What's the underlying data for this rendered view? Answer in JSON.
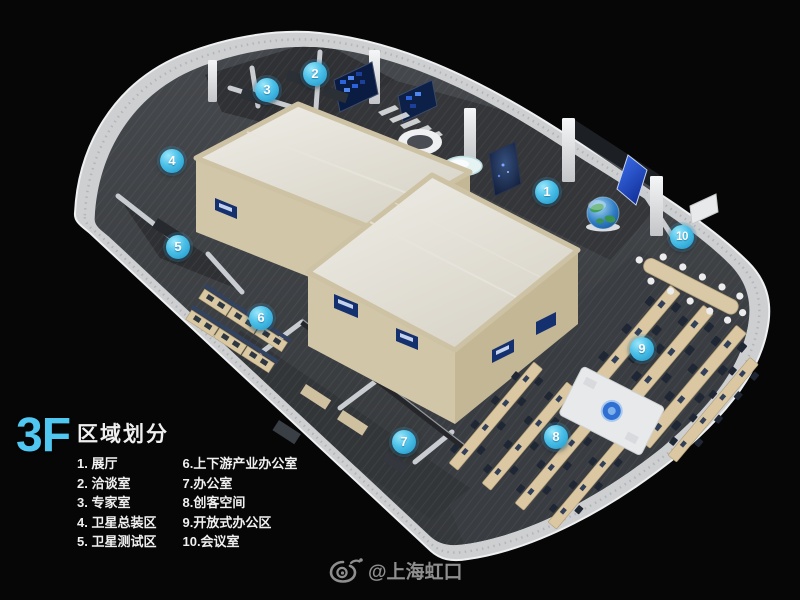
{
  "title": {
    "floor": "3F",
    "heading": "区域划分"
  },
  "legend": {
    "column1": [
      "1. 展厅",
      "2. 洽谈室",
      "3. 专家室",
      "4. 卫星总装区",
      "5. 卫星测试区"
    ],
    "column2": [
      "6.上下游产业办公室",
      "7.办公室",
      "8.创客空间",
      "9.开放式办公区",
      "10.会议室"
    ]
  },
  "area_markers": [
    {
      "label": "1",
      "x": 547,
      "y": 192
    },
    {
      "label": "2",
      "x": 315,
      "y": 74
    },
    {
      "label": "3",
      "x": 267,
      "y": 90
    },
    {
      "label": "4",
      "x": 172,
      "y": 161
    },
    {
      "label": "5",
      "x": 178,
      "y": 247
    },
    {
      "label": "6",
      "x": 261,
      "y": 318
    },
    {
      "label": "7",
      "x": 404,
      "y": 442
    },
    {
      "label": "8",
      "x": 556,
      "y": 437
    },
    {
      "label": "9",
      "x": 642,
      "y": 349
    },
    {
      "label": "10",
      "x": 682,
      "y": 237
    }
  ],
  "watermark": {
    "icon": "weibo-icon",
    "text": "@上海虹口"
  },
  "colors": {
    "background": "#060606",
    "marker_blue": "#35b0e0",
    "floor_label_cyan": "#4fc7f0",
    "legend_text": "#f0f0f0",
    "watermark_gray": "#9b9b9b",
    "building_cream": "#d2c6a8",
    "rim_white": "#cdcfd1",
    "floor_dark": "#3e4145"
  }
}
